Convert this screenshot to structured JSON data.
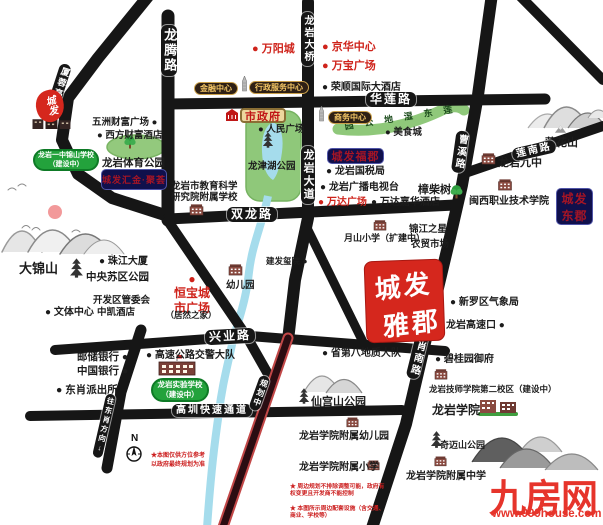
{
  "project": {
    "line1": "城发",
    "line2": "雅郡"
  },
  "logo": {
    "text": "城发"
  },
  "watermark": {
    "name": "九房网",
    "url": "www.999house.com"
  },
  "compass": {
    "n": "N",
    "note": "★本图仅供方位参考\n以政府最终规划为准"
  },
  "disclaimers": [
    "★ 周边规划不排除调整可能，政府有权变更且开发商不能控制",
    "★ 本图所示周边配套设施（含交通、商业、学校等）",
    "仅作示意参考。"
  ],
  "colors": {
    "road": "#161616",
    "accent_red": "#cf231b",
    "navy_badge": "#10104c",
    "gold_badge_text": "#f2c565",
    "park_green": "#8fc87a",
    "water_blue": "#a5dcec",
    "planned_road": "#2b0d12",
    "project_red": "#d5271d"
  },
  "road_labels": [
    {
      "text": "龙腾路",
      "x": 161,
      "y": 25,
      "mode": "v",
      "fs": 13
    },
    {
      "text": "厦蓉高速",
      "x": 59,
      "y": 64,
      "mode": "v",
      "fs": 9,
      "rot": 18
    },
    {
      "text": "龙岩大桥",
      "x": 301,
      "y": 12,
      "mode": "v",
      "fs": 10
    },
    {
      "text": "龙岩大道",
      "x": 301,
      "y": 146,
      "mode": "v",
      "fs": 11
    },
    {
      "text": "华莲路",
      "x": 366,
      "y": 92,
      "mode": "h",
      "fs": 12
    },
    {
      "text": "双龙路",
      "x": 227,
      "y": 207,
      "mode": "h",
      "fs": 12
    },
    {
      "text": "兴业路",
      "x": 205,
      "y": 329,
      "mode": "h",
      "fs": 12,
      "rot": -3
    },
    {
      "text": "莲南路",
      "x": 512,
      "y": 144,
      "mode": "h",
      "fs": 10,
      "rot": -13
    },
    {
      "text": "高圳快速通道",
      "x": 172,
      "y": 404,
      "mode": "h",
      "fs": 10
    },
    {
      "text": "曹溪路",
      "x": 456,
      "y": 131,
      "mode": "v",
      "fs": 10,
      "rot": 8
    },
    {
      "text": "东肖南路",
      "x": 417,
      "y": 326,
      "mode": "v",
      "fs": 10,
      "rot": 14
    },
    {
      "text": "往东肖方向↓",
      "x": 105,
      "y": 394,
      "mode": "v",
      "fs": 7.5,
      "rot": 13
    },
    {
      "text": "规划中",
      "x": 259,
      "y": 376,
      "mode": "v",
      "fs": 8,
      "rot": 20
    }
  ],
  "badges": [
    {
      "text": "金融中心",
      "x": 194,
      "y": 82,
      "cls": "gold",
      "fs": 8
    },
    {
      "text": "行政服务中心",
      "x": 249,
      "y": 81,
      "cls": "gold",
      "fs": 8
    },
    {
      "text": "商务中心",
      "x": 328,
      "y": 111,
      "cls": "gold",
      "fs": 8
    },
    {
      "text": "市政府",
      "x": 240,
      "y": 108,
      "cls": "gov",
      "fs": 11
    },
    {
      "text": "城发汇金·聚荟",
      "x": 101,
      "y": 169,
      "cls": "navy",
      "fs": 9,
      "w": 66,
      "h": 21
    },
    {
      "text": "城发福郡",
      "x": 327,
      "y": 148,
      "cls": "navy",
      "fs": 11,
      "w": 57,
      "h": 16
    },
    {
      "text": "城发\n东郡",
      "x": 556,
      "y": 188,
      "cls": "navy",
      "fs": 12,
      "w": 37,
      "h": 37
    },
    {
      "text": "龙岩一中锦山学校\n（建设中）",
      "x": 33,
      "y": 149,
      "cls": "school",
      "fs": 7,
      "w": 66
    },
    {
      "text": "龙岩实验学校\n（建设中）",
      "x": 151,
      "y": 378,
      "cls": "school",
      "fs": 7.5,
      "w": 58
    }
  ],
  "pois": [
    {
      "text": "● 万阳城",
      "x": 252,
      "y": 43,
      "cls": "red",
      "fs": 11
    },
    {
      "text": "● 京华中心",
      "x": 322,
      "y": 41,
      "cls": "red",
      "fs": 11
    },
    {
      "text": "● 万宝广场",
      "x": 322,
      "y": 60,
      "cls": "red",
      "fs": 11
    },
    {
      "text": "● 荣顺国际大酒店",
      "x": 322,
      "y": 82,
      "fs": 10
    },
    {
      "text": "五洲财富广场 ●",
      "x": 92,
      "y": 117
    },
    {
      "text": "● 西方财富酒店",
      "x": 97,
      "y": 130
    },
    {
      "text": "● 人民广场",
      "x": 258,
      "y": 124
    },
    {
      "text": "● 美食城",
      "x": 385,
      "y": 127
    },
    {
      "text": "龙岩体育公园",
      "x": 102,
      "y": 157,
      "fs": 10.5
    },
    {
      "text": "龙岩市教育科学\n研究院附属学校",
      "x": 171,
      "y": 181,
      "fs": 9.5
    },
    {
      "text": "● 龙岩国税局",
      "x": 326,
      "y": 166,
      "fs": 10
    },
    {
      "text": "● 龙岩广播电视台",
      "x": 320,
      "y": 182,
      "fs": 10
    },
    {
      "text": "● 万达广场",
      "x": 318,
      "y": 197,
      "cls": "red",
      "fs": 10
    },
    {
      "text": "● 万达嘉华酒店",
      "x": 371,
      "y": 197,
      "fs": 10
    },
    {
      "text": "樟柴树",
      "x": 418,
      "y": 184,
      "fs": 11
    },
    {
      "text": "闽西职业技术学院",
      "x": 469,
      "y": 196,
      "fs": 10
    },
    {
      "text": "龙岩九中",
      "x": 498,
      "y": 157,
      "fs": 11
    },
    {
      "text": "莲花山",
      "x": 545,
      "y": 137,
      "fs": 11
    },
    {
      "text": "月山小学（扩建中）",
      "x": 344,
      "y": 233,
      "fs": 9
    },
    {
      "text": "锦江之星",
      "x": 409,
      "y": 224
    },
    {
      "text": "农贸市场",
      "x": 411,
      "y": 239
    },
    {
      "text": "● 珠江大厦",
      "x": 99,
      "y": 256,
      "fs": 10
    },
    {
      "text": "中央苏区公园",
      "x": 86,
      "y": 271,
      "fs": 10.5
    },
    {
      "text": "开发区管委会",
      "x": 93,
      "y": 295
    },
    {
      "text": "● 文体中心",
      "x": 45,
      "y": 307,
      "fs": 10
    },
    {
      "text": "中凯酒店",
      "x": 97,
      "y": 307
    },
    {
      "text": "●\n恒宝城\n市广场",
      "x": 170,
      "y": 272,
      "cls": "red center",
      "fs": 12,
      "w": 44
    },
    {
      "text": "（居然之家）",
      "x": 164,
      "y": 310,
      "cls": "center",
      "fs": 8.5,
      "w": 54
    },
    {
      "text": "幼儿园",
      "x": 226,
      "y": 280
    },
    {
      "text": "建发玺院 ●",
      "x": 266,
      "y": 256,
      "fs": 8.5
    },
    {
      "text": "● 新罗区气象局",
      "x": 450,
      "y": 297,
      "fs": 10
    },
    {
      "text": "龙岩高速口 ●",
      "x": 446,
      "y": 320,
      "fs": 10
    },
    {
      "text": "● 省第八地质大队",
      "x": 322,
      "y": 348,
      "fs": 10
    },
    {
      "text": "● 碧桂园御府",
      "x": 435,
      "y": 354,
      "fs": 10
    },
    {
      "text": "龙岩技师学院第二校区（建设中）",
      "x": 429,
      "y": 384,
      "fs": 8.5
    },
    {
      "text": "龙岩学院",
      "x": 432,
      "y": 403,
      "fs": 12
    },
    {
      "text": "仙宫山公园",
      "x": 311,
      "y": 396,
      "fs": 11
    },
    {
      "text": "龙岩学院附属幼儿园",
      "x": 299,
      "y": 431,
      "fs": 10
    },
    {
      "text": "奇迈山公园",
      "x": 440,
      "y": 440,
      "fs": 9
    },
    {
      "text": "龙岩学院附属小学",
      "x": 299,
      "y": 462,
      "fs": 10
    },
    {
      "text": "龙岩学院附属中学",
      "x": 406,
      "y": 471,
      "fs": 10
    },
    {
      "text": "邮储银行 ●",
      "x": 77,
      "y": 351,
      "fs": 10.5
    },
    {
      "text": "中国银行 ●",
      "x": 77,
      "y": 365,
      "fs": 10.5
    },
    {
      "text": "● 东肖派出所",
      "x": 56,
      "y": 384,
      "fs": 10.5
    },
    {
      "text": "● 高速公路交警大队",
      "x": 146,
      "y": 350,
      "fs": 10
    },
    {
      "text": "大锦山",
      "x": 19,
      "y": 261,
      "fs": 13
    },
    {
      "text": "龙津湖公园",
      "x": 248,
      "y": 161,
      "fs": 9.5
    },
    {
      "text": "莲东湿地公园",
      "x": 344,
      "y": 112,
      "cls": "wetland",
      "fs": 9
    }
  ],
  "icons": [
    {
      "type": "tower",
      "name": "finance-tower",
      "x": 240,
      "y": 76,
      "w": 9,
      "h": 16
    },
    {
      "type": "tower",
      "name": "business-tower",
      "x": 317,
      "y": 106,
      "w": 9,
      "h": 16
    },
    {
      "type": "bldr",
      "name": "city-government-building",
      "x": 225,
      "y": 109,
      "w": 14,
      "h": 12
    },
    {
      "type": "bld",
      "name": "education-institute-school",
      "x": 189,
      "y": 203,
      "w": 15,
      "h": 13
    },
    {
      "type": "bld",
      "name": "kindergarten-building",
      "x": 228,
      "y": 263,
      "w": 15,
      "h": 13
    },
    {
      "type": "bld",
      "name": "no9-middle-school",
      "x": 481,
      "y": 152,
      "w": 15,
      "h": 13
    },
    {
      "type": "bld",
      "name": "minxi-college-building",
      "x": 492,
      "y": 178,
      "w": 26,
      "h": 13
    },
    {
      "type": "bld",
      "name": "yueshan-primary-school",
      "x": 373,
      "y": 219,
      "w": 14,
      "h": 12
    },
    {
      "type": "bld",
      "name": "technician-college-building",
      "x": 434,
      "y": 368,
      "w": 14,
      "h": 12
    },
    {
      "type": "bldc",
      "name": "longyan-university-campus",
      "x": 478,
      "y": 396,
      "w": 40,
      "h": 20
    },
    {
      "type": "bld",
      "name": "affiliated-kindergarten",
      "x": 346,
      "y": 416,
      "w": 13,
      "h": 12
    },
    {
      "type": "bld",
      "name": "affiliated-primary-school",
      "x": 367,
      "y": 459,
      "w": 13,
      "h": 12
    },
    {
      "type": "bld",
      "name": "affiliated-middle-school",
      "x": 434,
      "y": 455,
      "w": 13,
      "h": 12
    },
    {
      "type": "blds",
      "name": "experimental-school-building",
      "x": 156,
      "y": 354,
      "w": 42,
      "h": 22
    },
    {
      "type": "bldrow",
      "name": "chengfa-buildings-row",
      "x": 32,
      "y": 116,
      "w": 40,
      "h": 13
    },
    {
      "type": "pagoda",
      "name": "central-soviet-park-pagoda",
      "x": 69,
      "y": 258,
      "w": 15,
      "h": 20
    },
    {
      "type": "pagoda",
      "name": "longjin-lake-pagoda",
      "x": 262,
      "y": 132,
      "w": 12,
      "h": 16
    },
    {
      "type": "pagoda",
      "name": "xiangong-mountain-pagoda",
      "x": 298,
      "y": 388,
      "w": 12,
      "h": 16
    },
    {
      "type": "pagoda",
      "name": "qimai-mountain-pagoda",
      "x": 430,
      "y": 431,
      "w": 13,
      "h": 17
    },
    {
      "type": "tree",
      "name": "sports-park-tree",
      "x": 124,
      "y": 135,
      "w": 12,
      "h": 14
    },
    {
      "type": "tree",
      "name": "zhangchai-tree",
      "x": 450,
      "y": 184,
      "w": 13,
      "h": 15
    },
    {
      "type": "mt",
      "name": "lianhuashan-marker",
      "x": 554,
      "y": 124,
      "w": 13,
      "h": 10
    }
  ]
}
